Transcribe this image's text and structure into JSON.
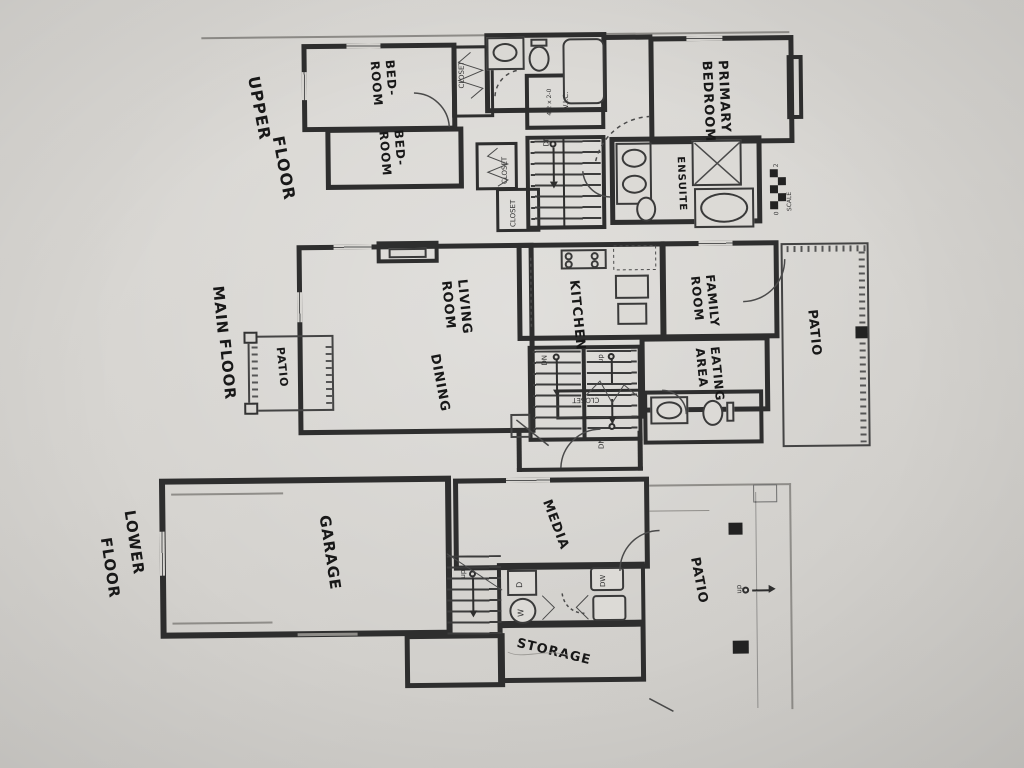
{
  "colors": {
    "paper": "#d7d5d1",
    "wall": "#2e2e2e",
    "ink": "#181818",
    "print": "#333333"
  },
  "upper": {
    "title_line1": "UPPER",
    "title_line2": "FLOOR",
    "bedroom1_line1": "BED-",
    "bedroom1_line2": "ROOM",
    "bedroom2_line1": "BED-",
    "bedroom2_line2": "ROOM",
    "primary_line1": "PRIMARY",
    "primary_line2": "BEDROOM",
    "ensuite": "ENSUITE",
    "wic": "W.I.C.",
    "wic_dims": "4-2 x 2-0",
    "dn": "DN",
    "scale_label": "SCALE",
    "scale_zero": "0",
    "scale_two": "2"
  },
  "main": {
    "title_line1": "MAIN",
    "title_line2": "FLOOR",
    "patio_left": "PATIO",
    "living_line1": "LIVING",
    "living_line2": "ROOM",
    "dining": "DINING",
    "kitchen": "KITCHEN",
    "family_line1": "FAMILY",
    "family_line2": "ROOM",
    "eating_line1": "EATING",
    "eating_line2": "AREA",
    "patio_right": "PATIO",
    "up": "up",
    "dn": "DN"
  },
  "lower": {
    "title_line1": "LOWER",
    "title_line2": "FLOOR",
    "garage": "GARAGE",
    "media": "MEDIA",
    "storage": "STORAGE",
    "patio": "PATIO",
    "dryer": "D",
    "washer": "W",
    "dishwasher": "DW",
    "up": "up"
  },
  "shared": {
    "closet": "CLOSET"
  }
}
